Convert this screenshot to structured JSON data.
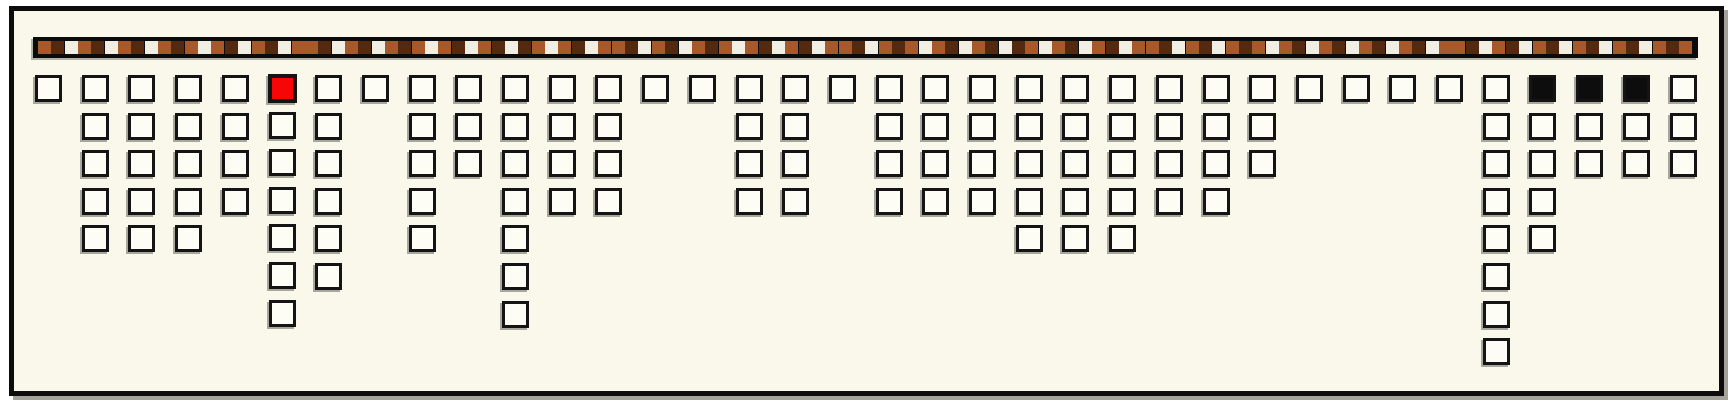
{
  "app": {
    "title": "mosaic timeline strip with hanging square columns",
    "background_color": "#faf8eb",
    "frame_border_color": "#0c0c0c",
    "page_background_color": "#ffffff"
  },
  "strip": {
    "description": "horizontal black band of small mosaic tiles",
    "tile_count": 124,
    "sequence": "mdwmdwmdwmdmwmdwmdwmmdwmdwmdmwmdwmdwdmwmdwmmdwmdwmdmwmdwmdwmmdwmdmwmdwmdwdmwmdwmdwmmdwmdwmdmwmdwmdwmdwmdwmmdwmdwmdwmdwmdwmdm",
    "colors": {
      "m": "#a8592b",
      "d": "#53290f",
      "w": "#f1efe3"
    },
    "band_color": "#0b0b0b"
  },
  "board": {
    "description": "36 columns of outlined square cells hanging below the strip",
    "column_count": 36,
    "column_heights": [
      1,
      5,
      5,
      5,
      4,
      7,
      6,
      1,
      5,
      3,
      7,
      4,
      4,
      1,
      1,
      4,
      4,
      1,
      4,
      4,
      4,
      5,
      5,
      5,
      4,
      4,
      3,
      1,
      1,
      1,
      1,
      8,
      5,
      3,
      3,
      3
    ],
    "cell_fill_color": "#fefdf5",
    "cell_border_color": "#141414",
    "special_cells": [
      {
        "column": 6,
        "row": 1,
        "style": "red",
        "color": "#f60606"
      },
      {
        "column": 33,
        "row": 1,
        "style": "black",
        "color": "#0d0d0d"
      },
      {
        "column": 34,
        "row": 1,
        "style": "black",
        "color": "#0d0d0d"
      },
      {
        "column": 35,
        "row": 1,
        "style": "black",
        "color": "#0d0d0d"
      }
    ]
  },
  "chart_data": {
    "type": "bar",
    "title": "",
    "xlabel": "",
    "ylabel": "",
    "categories": [
      1,
      2,
      3,
      4,
      5,
      6,
      7,
      8,
      9,
      10,
      11,
      12,
      13,
      14,
      15,
      16,
      17,
      18,
      19,
      20,
      21,
      22,
      23,
      24,
      25,
      26,
      27,
      28,
      29,
      30,
      31,
      32,
      33,
      34,
      35,
      36
    ],
    "values": [
      1,
      5,
      5,
      5,
      4,
      7,
      6,
      1,
      5,
      3,
      7,
      4,
      4,
      1,
      1,
      4,
      4,
      1,
      4,
      4,
      4,
      5,
      5,
      5,
      4,
      4,
      3,
      1,
      1,
      1,
      1,
      8,
      5,
      3,
      3,
      3
    ],
    "ylim": [
      0,
      8
    ],
    "orientation": "columns hang downward from a top timeline strip",
    "grid": false,
    "legend": false,
    "annotations": [
      "top cell of column 6 is highlighted red",
      "top cells of columns 33, 34, 35 are filled solid black",
      "all other cells are white squares with black outlines",
      "timeline strip above holds 124 small tiles in brown / dark-brown / off-white"
    ]
  }
}
